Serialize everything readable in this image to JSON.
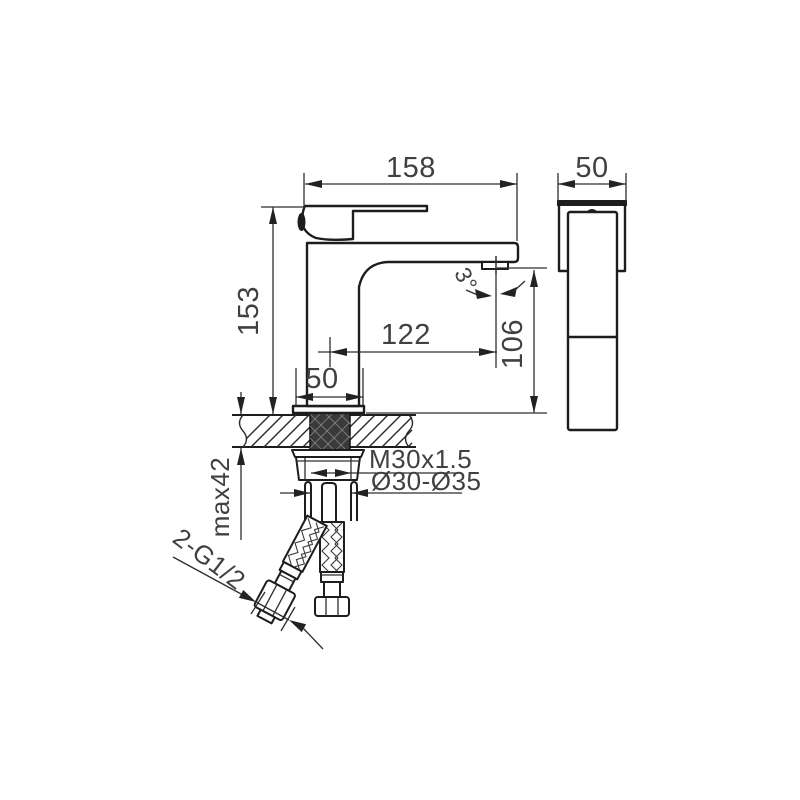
{
  "dimensions": {
    "total_length": "158",
    "side_width": "50",
    "total_height": "153",
    "spout_reach": "122",
    "spout_height": "106",
    "base_width": "50",
    "aerator_angle": "3°",
    "mounting_thread": "M30x1.5",
    "hole_diameter": "Ø30-Ø35",
    "max_counter_thickness": "max42",
    "hose_connection": "2-G1/2"
  },
  "colors": {
    "line": "#1d1d1d",
    "text": "#404040",
    "background": "#ffffff"
  }
}
